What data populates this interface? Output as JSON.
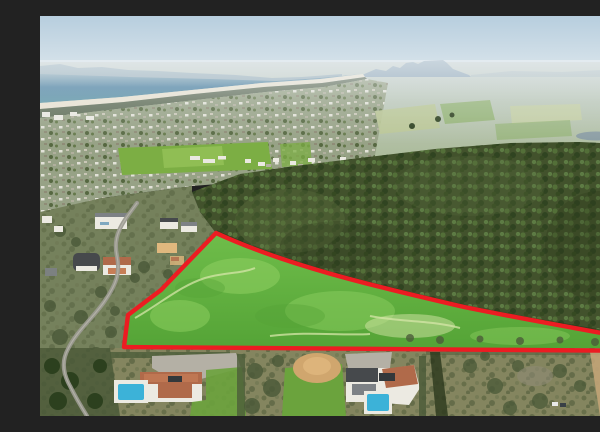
{
  "meta": {
    "alt": "Aerial photograph of a vacant land parcel outlined in red, bordered by a forest belt and luxury suburban homes, with suburbs, a white curving beach, the ocean bay and a flat-topped mountain on the hazy horizon",
    "width": 600,
    "height": 400
  },
  "colors": {
    "sky_top": "#b7cede",
    "sky_horizon": "#dfe8ed",
    "haze": "#edf2f5",
    "mountain_far": "#8ea7b6",
    "table_mountain": "#8aa2b6",
    "ocean_far": "#7fa2b2",
    "ocean_mid": "#42799c",
    "ocean_near": "#5f97a6",
    "beach": "#e9e2d1",
    "dune": "#57644e",
    "plains_far": "#c7d1cf",
    "plains_near": "#a9b995",
    "suburb": "#97a286",
    "sports_field": "#7cae44",
    "sports_field_light": "#97c35a",
    "farm_light": "#bac795",
    "farm_green": "#93b274",
    "farm_pale": "#c6d0a2",
    "dam_water": "#8598a3",
    "forest": "#42522c",
    "forest_light": "#5b7040",
    "forest_dark": "#2a371c",
    "forest_edge": "#233216",
    "hillside": "#75815c",
    "field_bright": "#6fbd4a",
    "field_main": "#54a336",
    "field_light": "#8ccd5f",
    "field_pale": "#d6e6a8",
    "boundary_red": "#ec1c22",
    "road": "#9b9a90",
    "road_line": "#c3c2b8",
    "wall_white": "#eceae2",
    "roof_dark": "#46494c",
    "roof_gray": "#7d8185",
    "roof_terracotta": "#b06a4a",
    "roof_terracotta_light": "#c67e57",
    "panel_dark": "#33383b",
    "pool": "#3cb2d8",
    "lawn": "#6ba33d",
    "scrub": "#84855f",
    "bush": "#4a5938",
    "sand": "#d0a66e",
    "sand_light": "#e0b87e",
    "paving": "#b4b0a5",
    "hedge": "#4c5c3a",
    "window_blue": "#7fa8c0",
    "car_white": "#e9e9e9",
    "car_dark": "#394046",
    "path_sand": "#c6a678"
  },
  "boundary": {
    "name": "property-boundary-outline",
    "path": "M 176 217 C 248 250 330 269 424 291 C 498 306 552 315 616 327 M 176 217 L 121 274 L 88 299 L 84 331 L 616 335",
    "stroke_width": 4.4
  }
}
